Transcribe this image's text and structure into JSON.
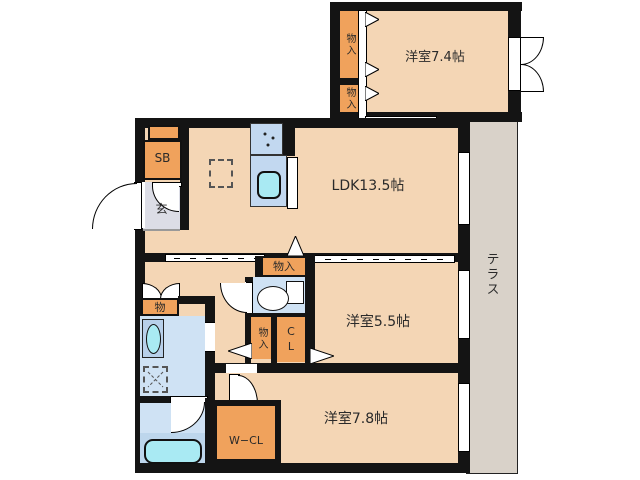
{
  "title": "apartment-floor-plan",
  "labels": {
    "room_west_74": "洋室7.4帖",
    "room_ldk": "LDK13.5帖",
    "room_west_55": "洋室5.5帖",
    "room_west_78": "洋室7.8帖",
    "terrace": "テラス",
    "entrance": "玄",
    "shoe_box": "SB",
    "closet_upper_a": "物入",
    "closet_upper_b": "物入",
    "closet_toilet_top": "物入",
    "closet_hall_lower": "物入",
    "closet_mono": "物",
    "closet_cl": "CL",
    "closet_wcl": "W−CL"
  },
  "colors": {
    "room_fill": "#f4d6b5",
    "storage_fill": "#f0a25c",
    "wet_area_fill": "#cfe2f4",
    "fixture_fill": "#a9eaf3",
    "tub_zone_fill": "#bdd6ec",
    "entrance_fill": "#dcdde6",
    "terrace_fill": "#d9d2c9",
    "wall": "#141414"
  }
}
